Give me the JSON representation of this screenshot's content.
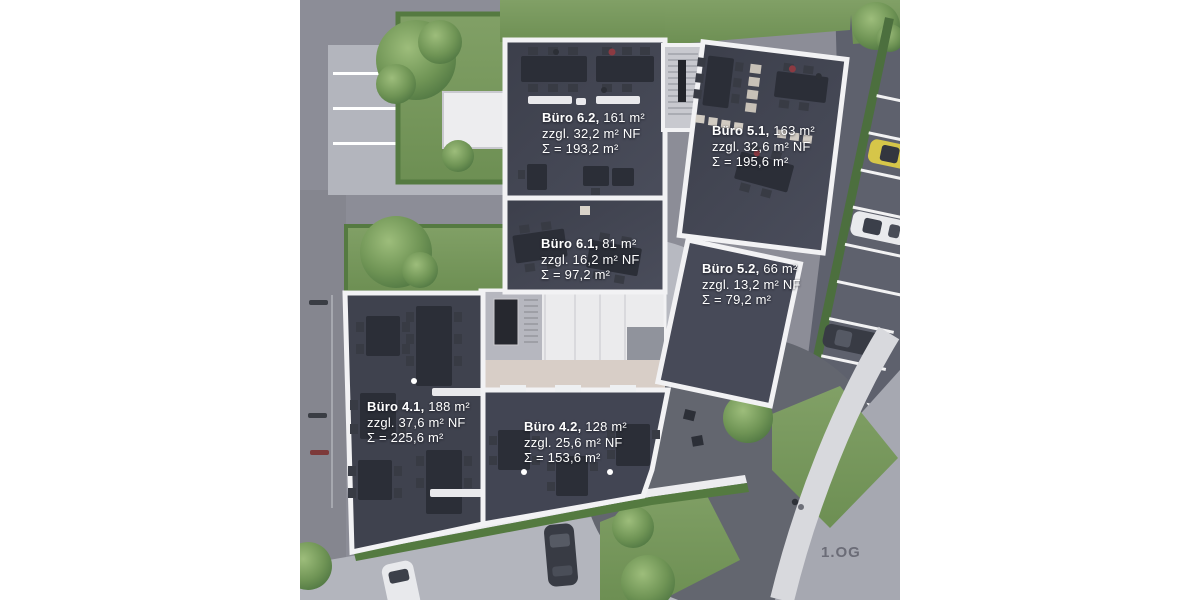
{
  "floor_plan": {
    "title": "Office floor plan rendering, first upper floor",
    "floor_label": "1.OG",
    "offices": [
      {
        "id": "buero-6-2",
        "name": "Büro 6.2,",
        "area": "161 m²",
        "addition": "zzgl. 32,2 m² NF",
        "total": "Σ = 193,2 m²"
      },
      {
        "id": "buero-5-1",
        "name": "Büro 5.1,",
        "area": "163 m²",
        "addition": "zzgl. 32,6 m² NF",
        "total": "Σ = 195,6 m²"
      },
      {
        "id": "buero-6-1",
        "name": "Büro 6.1,",
        "area": "81 m²",
        "addition": "zzgl. 16,2 m² NF",
        "total": "Σ = 97,2 m²"
      },
      {
        "id": "buero-5-2",
        "name": "Büro 5.2,",
        "area": "66 m²",
        "addition": "zzgl. 13,2 m² NF",
        "total": "Σ = 79,2 m²"
      },
      {
        "id": "buero-4-1",
        "name": "Büro 4.1,",
        "area": "188 m²",
        "addition": "zzgl. 37,6 m² NF",
        "total": "Σ = 225,6 m²"
      },
      {
        "id": "buero-4-2",
        "name": "Büro 4.2,",
        "area": "128 m²",
        "addition": "zzgl. 25,6 m² NF",
        "total": "Σ = 153,6 m²"
      }
    ],
    "colors": {
      "label_text": "#ffffff",
      "floor_label_text": "#6b6c77",
      "office_floor": "#414451",
      "walls": "#f2f2f4",
      "road_dark": "#5e616d",
      "road_light": "#b3b5bd",
      "grass": "#7d9a63",
      "hedge": "#547a40",
      "corridor": "#d8cec7",
      "car_yellow": "#d6c649"
    }
  }
}
